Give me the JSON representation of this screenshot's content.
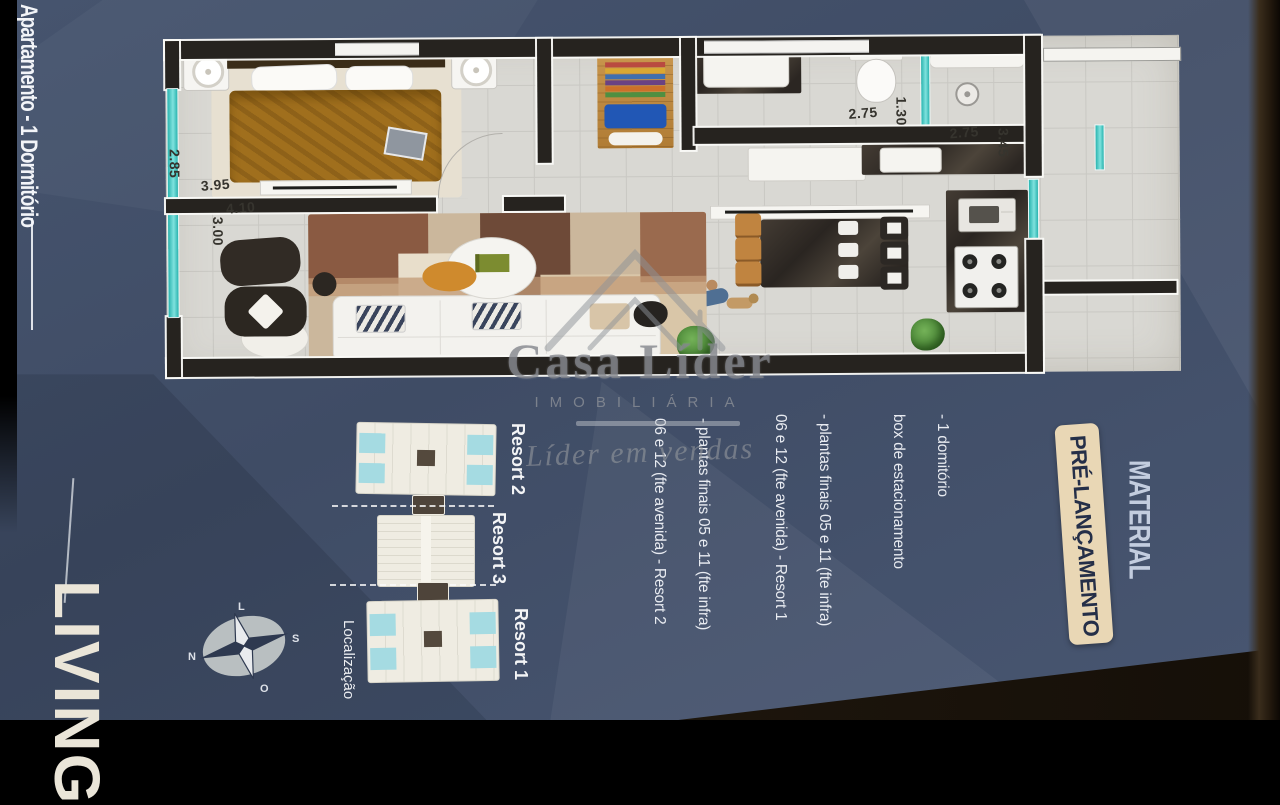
{
  "page": {
    "side_title": "Apartamento - 1 Dormitório",
    "living_label": "LIVING"
  },
  "promo": {
    "material_label": "MATERIAL",
    "badge_label": "PRÉ-LANÇAMENTO"
  },
  "watermark": {
    "brand": "Casa Líder",
    "subtitle": "IMOBILIÁRIA",
    "tagline": "Líder em vendas"
  },
  "details": {
    "features": [
      "- 1 domitório",
      "box de estacionamento"
    ],
    "notes": [
      {
        "line1": "- plantas finais 05 e 11 (fte infra)",
        "line2": "06 e 12 (fte avenida) - Resort 1"
      },
      {
        "line1": "- plantas finais 05 e 11 (fte infra)",
        "line2": "06 e 12  (fte avenida) - Resort 2"
      }
    ]
  },
  "site_map": {
    "label": "Localização",
    "buildings": [
      {
        "name": "Resort 2"
      },
      {
        "name": "Resort 3"
      },
      {
        "name": "Resort 1"
      }
    ],
    "compass": {
      "top": "L",
      "right": "S",
      "left": "N",
      "bottom": "O"
    }
  },
  "floor_plan": {
    "dimensions": {
      "bedroom_width": "2.85",
      "bedroom_length": "3.95",
      "living_length": "4.10",
      "living_width": "3.00",
      "bath_width": "2.75",
      "bath_depth": "1.30",
      "suite_width": "2.75",
      "suite_depth": "3.45"
    }
  },
  "colors": {
    "background_navy": "#3f4c65",
    "accent_teal": "#2ab4af",
    "badge_beige": "#e9d7b5",
    "wall_black": "#26231f"
  }
}
